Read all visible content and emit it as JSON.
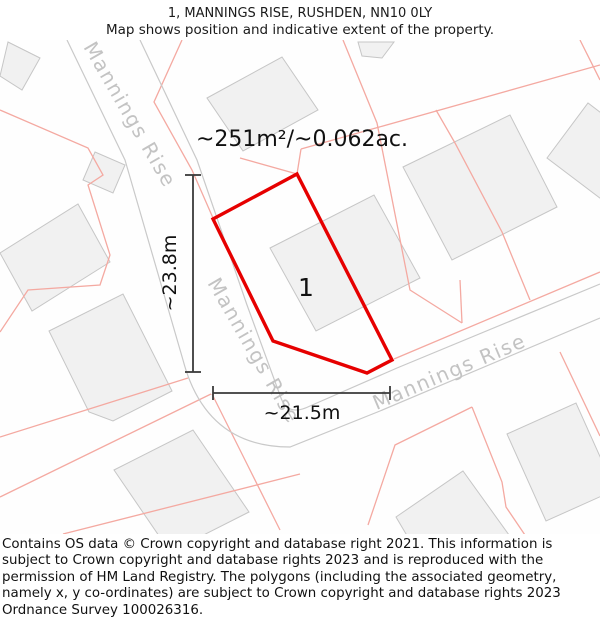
{
  "header": {
    "title": "1, MANNINGS RISE, RUSHDEN, NN10 0LY",
    "subtitle": "Map shows position and indicative extent of the property."
  },
  "map": {
    "area_label": "~251m²/~0.062ac.",
    "plot_number": "1",
    "width_label": "~21.5m",
    "height_label": "~23.8m",
    "road_name": "Mannings Rise",
    "colors": {
      "red": "#e60000",
      "pink": "#f4a9a1",
      "road_edge": "#c9c9c9",
      "building_fill": "#f1f1f1",
      "building_stroke": "#c6c6c6",
      "road_label": "#c3c3c3",
      "measure": "#3a3a3a",
      "text": "#111111"
    },
    "red_polygon": [
      [
        297,
        174
      ],
      [
        392,
        360
      ],
      [
        367,
        373
      ],
      [
        273,
        341
      ],
      [
        213,
        219
      ]
    ],
    "roads": [
      "M67,40 L125,160 L183,360 Q206,447 290,447 L380,411 L600,318",
      "M140,40 L197,160 L247,305 L281,398 Q288,417 310,406 L397,368 L600,284"
    ],
    "pink_lines": [
      [
        [
          182,
          40
        ],
        [
          154,
          102
        ],
        [
          192,
          170
        ],
        [
          213,
          218
        ]
      ],
      [
        [
          0,
          110
        ],
        [
          88,
          148
        ],
        [
          103,
          175
        ],
        [
          88,
          185
        ],
        [
          110,
          255
        ],
        [
          100,
          285
        ],
        [
          28,
          290
        ],
        [
          0,
          332
        ]
      ],
      [
        [
          240,
          158
        ],
        [
          297,
          174
        ]
      ],
      [
        [
          297,
          174
        ],
        [
          301,
          149
        ]
      ],
      [
        [
          301,
          149
        ],
        [
          600,
          65
        ]
      ],
      [
        [
          343,
          40
        ],
        [
          377,
          123
        ],
        [
          410,
          290
        ],
        [
          462,
          323
        ]
      ],
      [
        [
          460,
          280
        ],
        [
          462,
          323
        ]
      ],
      [
        [
          436,
          110
        ],
        [
          455,
          143
        ],
        [
          502,
          232
        ],
        [
          530,
          300
        ]
      ],
      [
        [
          580,
          40
        ],
        [
          600,
          80
        ]
      ],
      [
        [
          394,
          359
        ],
        [
          600,
          272
        ]
      ],
      [
        [
          0,
          437
        ],
        [
          188,
          378
        ]
      ],
      [
        [
          0,
          497
        ],
        [
          211,
          394
        ]
      ],
      [
        [
          63,
          534
        ],
        [
          300,
          474
        ]
      ],
      [
        [
          212,
          394
        ],
        [
          246,
          462
        ],
        [
          280,
          530
        ]
      ],
      [
        [
          560,
          352
        ],
        [
          600,
          436
        ]
      ],
      [
        [
          472,
          407
        ],
        [
          395,
          445
        ],
        [
          368,
          525
        ]
      ],
      [
        [
          472,
          407
        ],
        [
          502,
          482
        ],
        [
          506,
          507
        ],
        [
          527,
          538
        ]
      ]
    ],
    "buildings": [
      [
        [
          8,
          42
        ],
        [
          40,
          58
        ],
        [
          22,
          90
        ],
        [
          0,
          76
        ]
      ],
      [
        [
          95,
          152
        ],
        [
          125,
          165
        ],
        [
          113,
          193
        ],
        [
          83,
          180
        ]
      ],
      [
        [
          78,
          204
        ],
        [
          110,
          262
        ],
        [
          32,
          311
        ],
        [
          0,
          253
        ]
      ],
      [
        [
          123,
          294
        ],
        [
          172,
          391
        ],
        [
          113,
          421
        ],
        [
          89,
          412
        ],
        [
          49,
          331
        ]
      ],
      [
        [
          207,
          98
        ],
        [
          282,
          57
        ],
        [
          318,
          110
        ],
        [
          243,
          151
        ]
      ],
      [
        [
          358,
          42
        ],
        [
          394,
          42
        ],
        [
          382,
          58
        ],
        [
          362,
          56
        ]
      ],
      [
        [
          270,
          248
        ],
        [
          374,
          195
        ],
        [
          420,
          278
        ],
        [
          316,
          331
        ]
      ],
      [
        [
          403,
          167
        ],
        [
          510,
          115
        ],
        [
          557,
          207
        ],
        [
          452,
          260
        ]
      ],
      [
        [
          547,
          158
        ],
        [
          588,
          103
        ],
        [
          650,
          150
        ],
        [
          609,
          205
        ]
      ],
      [
        [
          193,
          430
        ],
        [
          249,
          512
        ],
        [
          170,
          552
        ],
        [
          114,
          470
        ]
      ],
      [
        [
          463,
          471
        ],
        [
          527,
          560
        ],
        [
          448,
          605
        ],
        [
          396,
          517
        ]
      ],
      [
        [
          507,
          434
        ],
        [
          576,
          403
        ],
        [
          615,
          490
        ],
        [
          546,
          521
        ]
      ]
    ],
    "road_labels": [
      {
        "x": 124,
        "y": 118,
        "rotate": 60
      },
      {
        "x": 248,
        "y": 354,
        "rotate": 60
      },
      {
        "x": 452,
        "y": 378,
        "rotate": -23
      }
    ],
    "area_label_pos": {
      "x": 302,
      "y": 146,
      "size": 22
    },
    "plot_number_pos": {
      "x": 306,
      "y": 296,
      "size": 25
    },
    "measure": {
      "v_line": [
        193,
        175,
        193,
        372
      ],
      "v_ticks": [
        [
          185,
          175,
          201,
          175
        ],
        [
          185,
          372,
          201,
          372
        ]
      ],
      "v_label_pos": {
        "x": 176,
        "y": 273,
        "size": 19
      },
      "h_line": [
        213,
        393,
        390,
        393
      ],
      "h_ticks": [
        [
          213,
          386,
          213,
          400
        ],
        [
          390,
          386,
          390,
          400
        ]
      ],
      "h_label_pos": {
        "x": 302,
        "y": 419,
        "size": 19
      }
    }
  },
  "footer": {
    "text": "Contains OS data © Crown copyright and database right 2021. This information is subject to Crown copyright and database rights 2023 and is reproduced with the permission of HM Land Registry. The polygons (including the associated geometry, namely x, y co-ordinates) are subject to Crown copyright and database rights 2023 Ordnance Survey 100026316."
  }
}
